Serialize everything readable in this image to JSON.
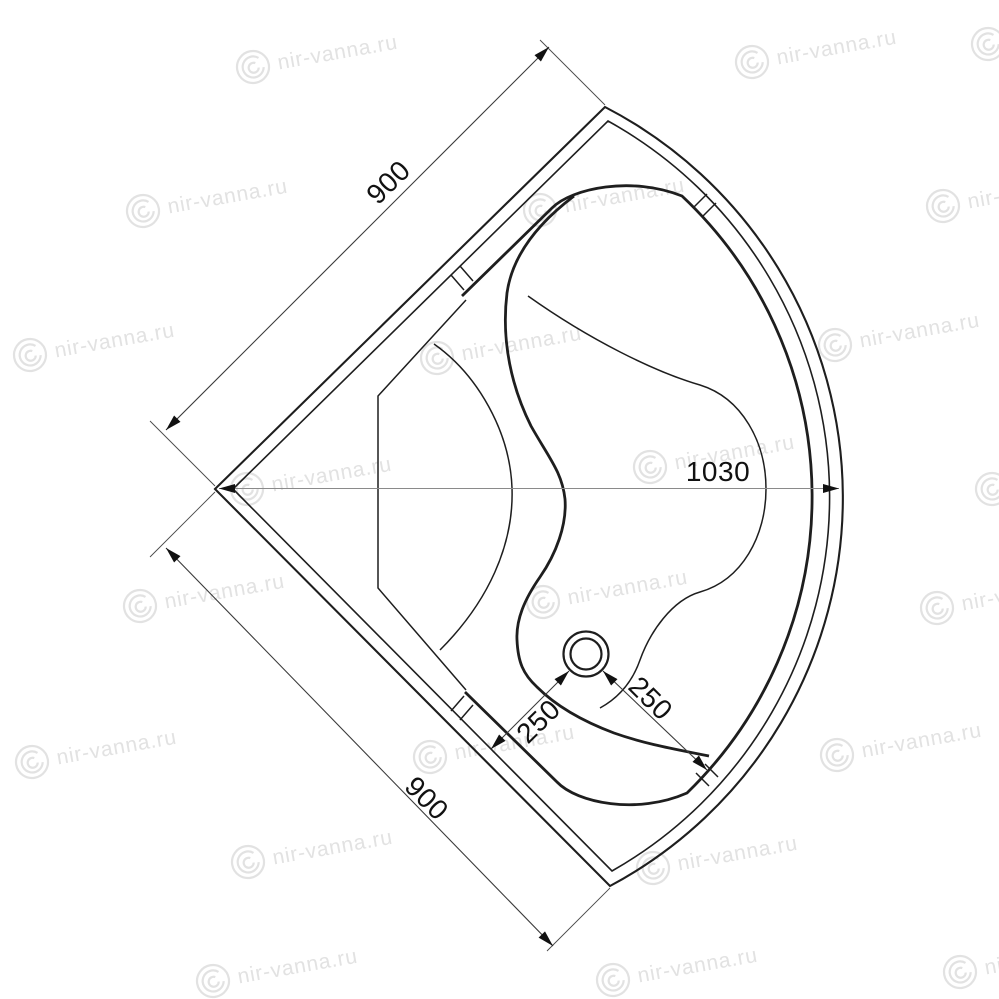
{
  "watermark": {
    "text": "nir-vanna.ru",
    "color": "#e2e2e2",
    "rotation_deg": -10,
    "positions": [
      [
        253,
        67
      ],
      [
        752,
        62
      ],
      [
        988,
        44
      ],
      [
        143,
        211
      ],
      [
        540,
        210
      ],
      [
        943,
        206
      ],
      [
        30,
        355
      ],
      [
        437,
        358
      ],
      [
        835,
        345
      ],
      [
        247,
        489
      ],
      [
        650,
        467
      ],
      [
        992,
        489
      ],
      [
        140,
        606
      ],
      [
        543,
        602
      ],
      [
        937,
        608
      ],
      [
        32,
        762
      ],
      [
        430,
        757
      ],
      [
        837,
        755
      ],
      [
        248,
        862
      ],
      [
        653,
        868
      ],
      [
        213,
        981
      ],
      [
        613,
        980
      ],
      [
        960,
        972
      ]
    ]
  },
  "dims": {
    "side_a": "900",
    "side_b": "900",
    "diagonal": "1030",
    "drain_left": "250",
    "drain_right": "250"
  }
}
